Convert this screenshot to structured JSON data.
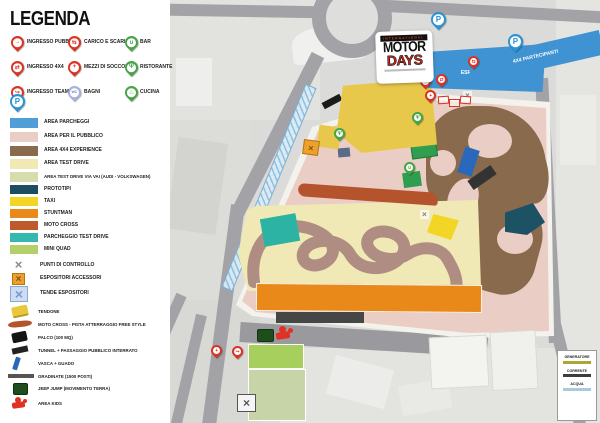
{
  "title": "LEGENDA",
  "legend": {
    "pins": [
      {
        "label": "INGRESSO PUBBLICO",
        "icon": "walking-icon",
        "glyph": "→"
      },
      {
        "label": "INGRESSO 4X4",
        "icon": "car-icon",
        "glyph": "⇄"
      },
      {
        "label": "INGRESSO TEAM",
        "icon": "door-arrow-icon",
        "glyph": "↪"
      },
      {
        "label": "CARICO E SCARICO",
        "icon": "truck-icon",
        "glyph": "⇆"
      },
      {
        "label": "MEZZI DI SOCCORSO",
        "icon": "medical-cross-icon",
        "glyph": "+"
      },
      {
        "label": "BAGNI",
        "icon": "wc-icon",
        "glyph": "WC"
      },
      {
        "label": "BAR",
        "icon": "cup-icon",
        "glyph": "∪"
      },
      {
        "label": "RISTORANTE",
        "icon": "fork-knife-icon",
        "glyph": "Ψ"
      },
      {
        "label": "CUCINA",
        "icon": "kitchen-icon",
        "glyph": "♨"
      }
    ],
    "parking_pin_glyph": "P",
    "areas": [
      {
        "label": "AREA PARCHEGGI",
        "color": "#4f9fd6"
      },
      {
        "label": "AREA PER IL PUBBLICO",
        "color": "#eacdc5"
      },
      {
        "label": "AREA 4X4 EXPERIENCE",
        "color": "#8a6a4c"
      },
      {
        "label": "AREA TEST DRIVE",
        "color": "#f0e9b6"
      },
      {
        "label": "AREA TEST DRIVE VIA VAI (AUDI - VOLKSWAGEN)",
        "color": "#d5dcae"
      }
    ],
    "zones": [
      {
        "label": "PROTOTIPI",
        "color": "#1d4e60"
      },
      {
        "label": "TAXI",
        "color": "#f2d525"
      },
      {
        "label": "STUNTMAN",
        "color": "#e8891a"
      },
      {
        "label": "MOTO CROSS",
        "color": "#c05a2a"
      },
      {
        "label": "PARCHEGGIO TEST DRIVE",
        "color": "#35b8b0"
      },
      {
        "label": "MINI QUAD",
        "color": "#b5d06a"
      }
    ],
    "symbols": [
      {
        "label": "PUNTI DI CONTROLLO",
        "icon": "gray-x-icon",
        "glyph": "×"
      },
      {
        "label": "ESPOSITORI ACCESSORI",
        "icon": "orange-x-box-icon",
        "glyph": "×"
      },
      {
        "label": "TENDE ESPOSITORI",
        "icon": "blue-x-box-icon",
        "glyph": "×"
      }
    ],
    "shapes": [
      {
        "label": "TENDONE"
      },
      {
        "label": "MOTO CROSS - PISTA ATTERRAGGIO FREE STYLE"
      },
      {
        "label": "PALCO (100 MQ)"
      },
      {
        "label": "TUNNEL + PASSAGGIO PUBBLICO INTERRATO"
      },
      {
        "label": "VASCA + GUADO"
      },
      {
        "label": "GRADINATE (1500 POSTI)"
      },
      {
        "label": "JEEP JUMP (MOVIMENTO TERRA)"
      },
      {
        "label": "AREA KIDS"
      }
    ]
  },
  "map": {
    "logo": {
      "top": "INTERNATIONAL",
      "main": "MOTOR",
      "sub": "DAYS"
    },
    "parking_labels": {
      "staff": "ESPOSITORI E STAFF",
      "participants": "4X4 PARTECIPANTI"
    },
    "utilities": [
      {
        "label": "GENERATORE"
      },
      {
        "label": "CORRENTE"
      },
      {
        "label": "ACQUA"
      }
    ]
  },
  "colors": {
    "red_pin": "#d93425",
    "green_pin": "#45a545",
    "blue_pin": "#2a93d5",
    "lavender_pin": "#a8b0dc",
    "parking_zone": "#3f93d2",
    "public_area": "#eacdc5",
    "experience_area": "#8a6a4c",
    "test_drive_area": "#f0e9b6",
    "test_drive_via": "#d5dcae",
    "prototipi": "#1d4e60",
    "taxi": "#f2d525",
    "stuntman": "#e8891a",
    "moto_cross": "#c05a2a",
    "parcheggio_test_drive": "#35b8b0",
    "mini_quad": "#b5d06a",
    "road": "#a3a3a7"
  }
}
